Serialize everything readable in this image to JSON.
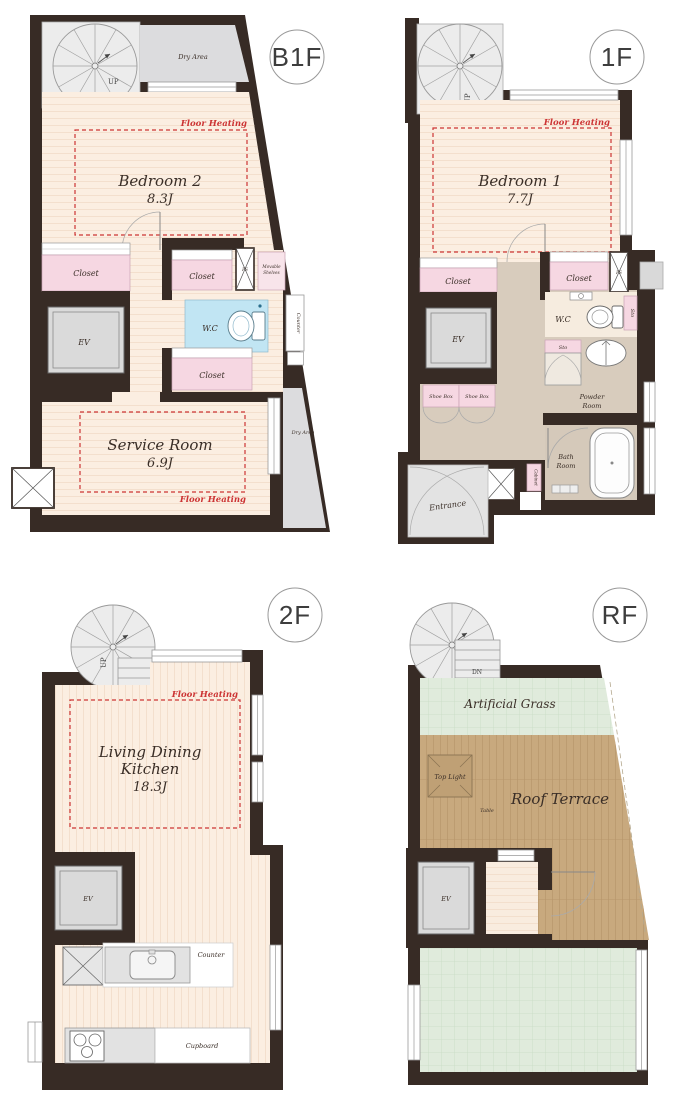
{
  "document_type": "residential-floor-plan",
  "palette": {
    "wall": "#372b25",
    "floor_cream": "#fbeee1",
    "floor_stripe": "#f3dfcd",
    "corridor_taupe": "#d8ccbd",
    "closet_pink": "#f6d7e2",
    "shelves_pink": "#f8e4ea",
    "wc_blue": "#c1e5f3",
    "area_gray": "#dcdcde",
    "ev_gray": "#dadada",
    "stair_gray": "#ececec",
    "grass_green": "#e0ebdc",
    "deck_tan": "#c8a97e",
    "heating_red": "#cc3434",
    "entrance_gray": "#e3e3e3"
  },
  "floors": [
    {
      "label": "B1F",
      "stair_dir": "UP",
      "dry_area_top": "Dry Area",
      "dry_area_bottom": "Dry Area",
      "floor_heating_bedroom": "Floor Heating",
      "floor_heating_service": "Floor Heating",
      "bedroom_name": "Bedroom 2",
      "bedroom_size": "8.3J",
      "closet_left": "Closet",
      "closet_center": "Closet",
      "closet_lower": "Closet",
      "movable_shelves_line1": "Movable",
      "movable_shelves_line2": "Shelves",
      "ps": "PS",
      "wc": "W.C",
      "counter": "Counter",
      "ev": "EV",
      "service_name": "Service Room",
      "service_size": "6.9J"
    },
    {
      "label": "1F",
      "stair_dir": "UP",
      "floor_heating": "Floor Heating",
      "bedroom_name": "Bedroom 1",
      "bedroom_size": "7.7J",
      "closet_left": "Closet",
      "closet_right": "Closet",
      "ps": "PS",
      "ev": "EV",
      "wc": "W.C",
      "sto_upper": "Sto",
      "sto_lower": "Sto",
      "shoe_box_left": "Shoe Box",
      "shoe_box_right": "Shoe Box",
      "powder_line1": "Powder",
      "powder_line2": "Room",
      "bath_line1": "Bath",
      "bath_line2": "Room",
      "cabinet": "Cabinet",
      "entrance": "Entrance"
    },
    {
      "label": "2F",
      "stair_dir": "UP",
      "floor_heating": "Floor Heating",
      "ldk_line1": "Living Dining",
      "ldk_line2": "Kitchen",
      "ldk_size": "18.3J",
      "ev": "EV",
      "counter": "Counter",
      "cupboard": "Cupboard"
    },
    {
      "label": "RF",
      "stair_dir": "DN",
      "artificial_grass": "Artificial Grass",
      "top_light": "Top Light",
      "table": "Table",
      "roof_terrace": "Roof Terrace",
      "ev": "EV"
    }
  ]
}
